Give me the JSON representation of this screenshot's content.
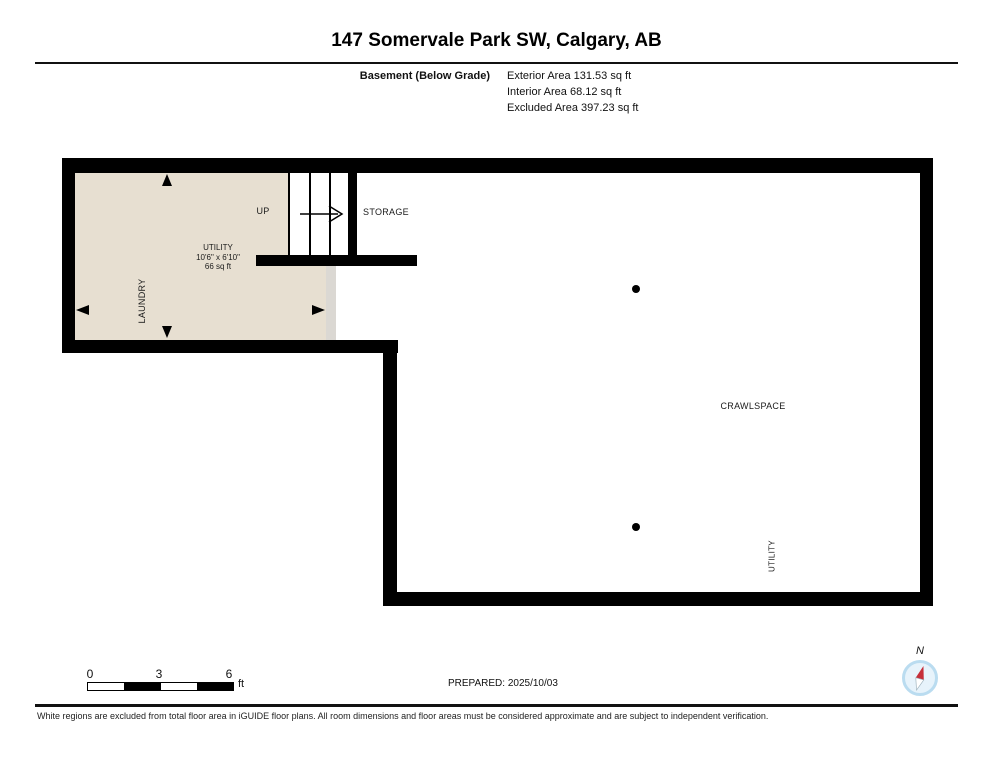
{
  "header": {
    "title": "147 Somervale Park SW, Calgary, AB",
    "floor_label": "Basement (Below Grade)",
    "area_lines": [
      "Exterior Area 131.53 sq ft",
      "Interior Area 68.12 sq ft",
      "Excluded Area 397.23 sq ft"
    ]
  },
  "plan": {
    "labels": {
      "up": "UP",
      "storage": "STORAGE",
      "laundry": "LAUNDRY",
      "crawlspace": "CRAWLSPACE",
      "utility_right": "UTILITY",
      "utility": {
        "name": "UTILITY",
        "dims": "10'6\" x 6'10\"",
        "area": "66 sq ft"
      }
    },
    "post_dots": 2
  },
  "footer": {
    "scale": {
      "ticks": [
        "0",
        "3",
        "6"
      ],
      "unit": "ft"
    },
    "prepared": "PREPARED: 2025/10/03",
    "compass_label": "N",
    "disclaimer": "White regions are excluded from total floor area in iGUIDE floor plans. All room dimensions and floor areas must be considered approximate and are subject to independent verification."
  },
  "colors": {
    "room_fill": "#e7dfd1",
    "wall": "#000000",
    "wall_opening": "#dbd8d3",
    "compass_ring": "#badcf0",
    "compass_fill": "#e7f3fb",
    "compass_needle_red": "#c62f39"
  }
}
